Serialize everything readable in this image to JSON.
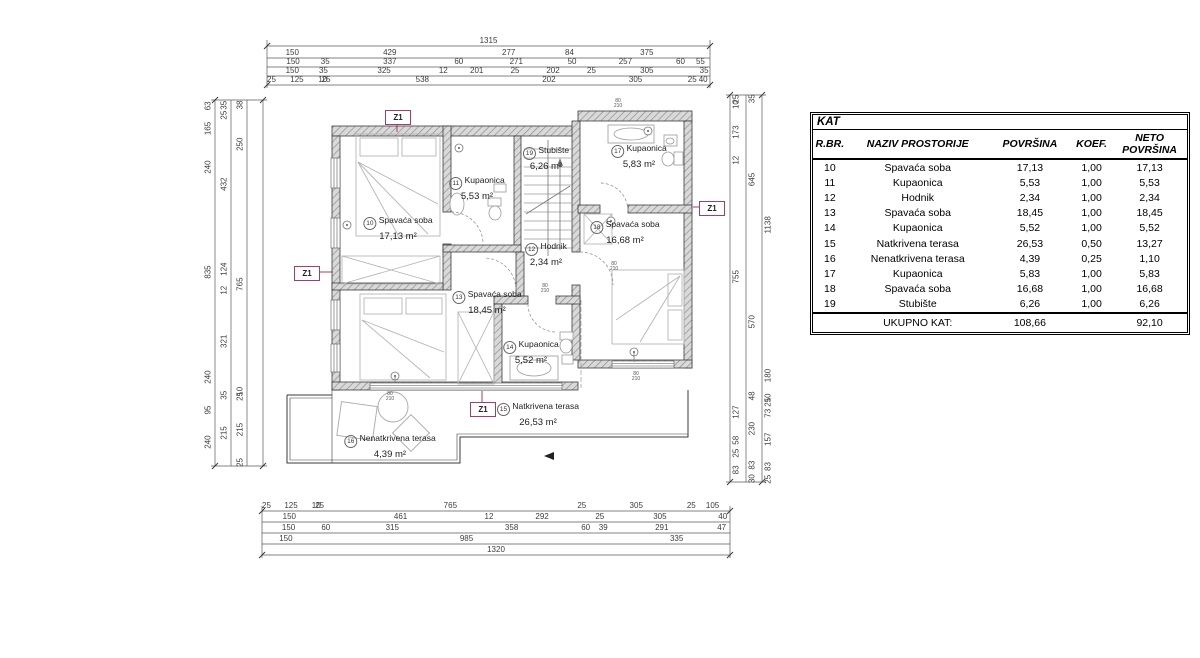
{
  "table": {
    "title": "KAT",
    "columns": [
      "R.BR.",
      "NAZIV PROSTORIJE",
      "POVRŠINA",
      "KOEF.",
      "NETO POVRŠINA"
    ],
    "rows": [
      [
        "10",
        "Spavaća soba",
        "17,13",
        "1,00",
        "17,13"
      ],
      [
        "11",
        "Kupaonica",
        "5,53",
        "1,00",
        "5,53"
      ],
      [
        "12",
        "Hodnik",
        "2,34",
        "1,00",
        "2,34"
      ],
      [
        "13",
        "Spavaća soba",
        "18,45",
        "1,00",
        "18,45"
      ],
      [
        "14",
        "Kupaonica",
        "5,52",
        "1,00",
        "5,52"
      ],
      [
        "15",
        "Natkrivena terasa",
        "26,53",
        "0,50",
        "13,27"
      ],
      [
        "16",
        "Nenatkrivena terasa",
        "4,39",
        "0,25",
        "1,10"
      ],
      [
        "17",
        "Kupaonica",
        "5,83",
        "1,00",
        "5,83"
      ],
      [
        "18",
        "Spavaća soba",
        "16,68",
        "1,00",
        "16,68"
      ],
      [
        "19",
        "Stubište",
        "6,26",
        "1,00",
        "6,26"
      ]
    ],
    "total": {
      "label": "UKUPNO KAT:",
      "povrsina": "108,66",
      "neto": "92,10"
    }
  },
  "plan": {
    "marker": "Z1",
    "door_tag": {
      "w": "80",
      "h": "210"
    },
    "rooms": [
      {
        "num": "10",
        "name": "Spavaća soba",
        "area": "17,13 m²"
      },
      {
        "num": "11",
        "name": "Kupaonica",
        "area": "5,53 m²"
      },
      {
        "num": "12",
        "name": "Hodnik",
        "area": "2,34 m²"
      },
      {
        "num": "13",
        "name": "Spavaća soba",
        "area": "18,45 m²"
      },
      {
        "num": "14",
        "name": "Kupaonica",
        "area": "5,52 m²"
      },
      {
        "num": "15",
        "name": "Natkrivena terasa",
        "area": "26,53 m²"
      },
      {
        "num": "16",
        "name": "Nenatkrivena terasa",
        "area": "4,39 m²"
      },
      {
        "num": "17",
        "name": "Kupaonica",
        "area": "5,83 m²"
      },
      {
        "num": "18",
        "name": "Spavaća soba",
        "area": "16,68 m²"
      },
      {
        "num": "19",
        "name": "Stubište",
        "area": "6,26 m²"
      }
    ],
    "dims": {
      "top": [
        [
          "1315"
        ],
        [
          "150",
          "429",
          "277",
          "84",
          "375"
        ],
        [
          "150",
          "35",
          "337",
          "60",
          "271",
          "50",
          "257",
          "60",
          "55"
        ],
        [
          "150",
          "35",
          "325",
          "12",
          "201",
          "25",
          "202",
          "25",
          "305",
          "35"
        ],
        [
          "25",
          "125",
          "10",
          "25",
          "538",
          "202",
          "305",
          "25",
          "40"
        ]
      ],
      "bottom": [
        [
          "25",
          "125",
          "10",
          "25",
          "765",
          "25",
          "305",
          "25",
          "105"
        ],
        [
          "150",
          "461",
          "12",
          "292",
          "25",
          "305",
          "40"
        ],
        [
          "150",
          "60",
          "315",
          "358",
          "60",
          "39",
          "291",
          "47"
        ],
        [
          "150",
          "985",
          "335"
        ],
        [
          "1320"
        ]
      ],
      "left": [
        [
          "63",
          "165",
          "240",
          "835",
          "240",
          "95",
          "240"
        ],
        [
          "35",
          "25",
          "432",
          "124",
          "12",
          "321",
          "35",
          "215"
        ],
        [
          "38",
          "250",
          "765",
          "10",
          "25",
          "215",
          "25"
        ]
      ],
      "right": [
        [
          "25",
          "10",
          "173",
          "12",
          "755",
          "127",
          "58",
          "25",
          "83"
        ],
        [
          "35",
          "645",
          "570",
          "48",
          "230",
          "83",
          "30"
        ],
        [
          "1138",
          "180",
          "10",
          "25",
          "73",
          "157",
          "83",
          "25"
        ]
      ]
    }
  }
}
